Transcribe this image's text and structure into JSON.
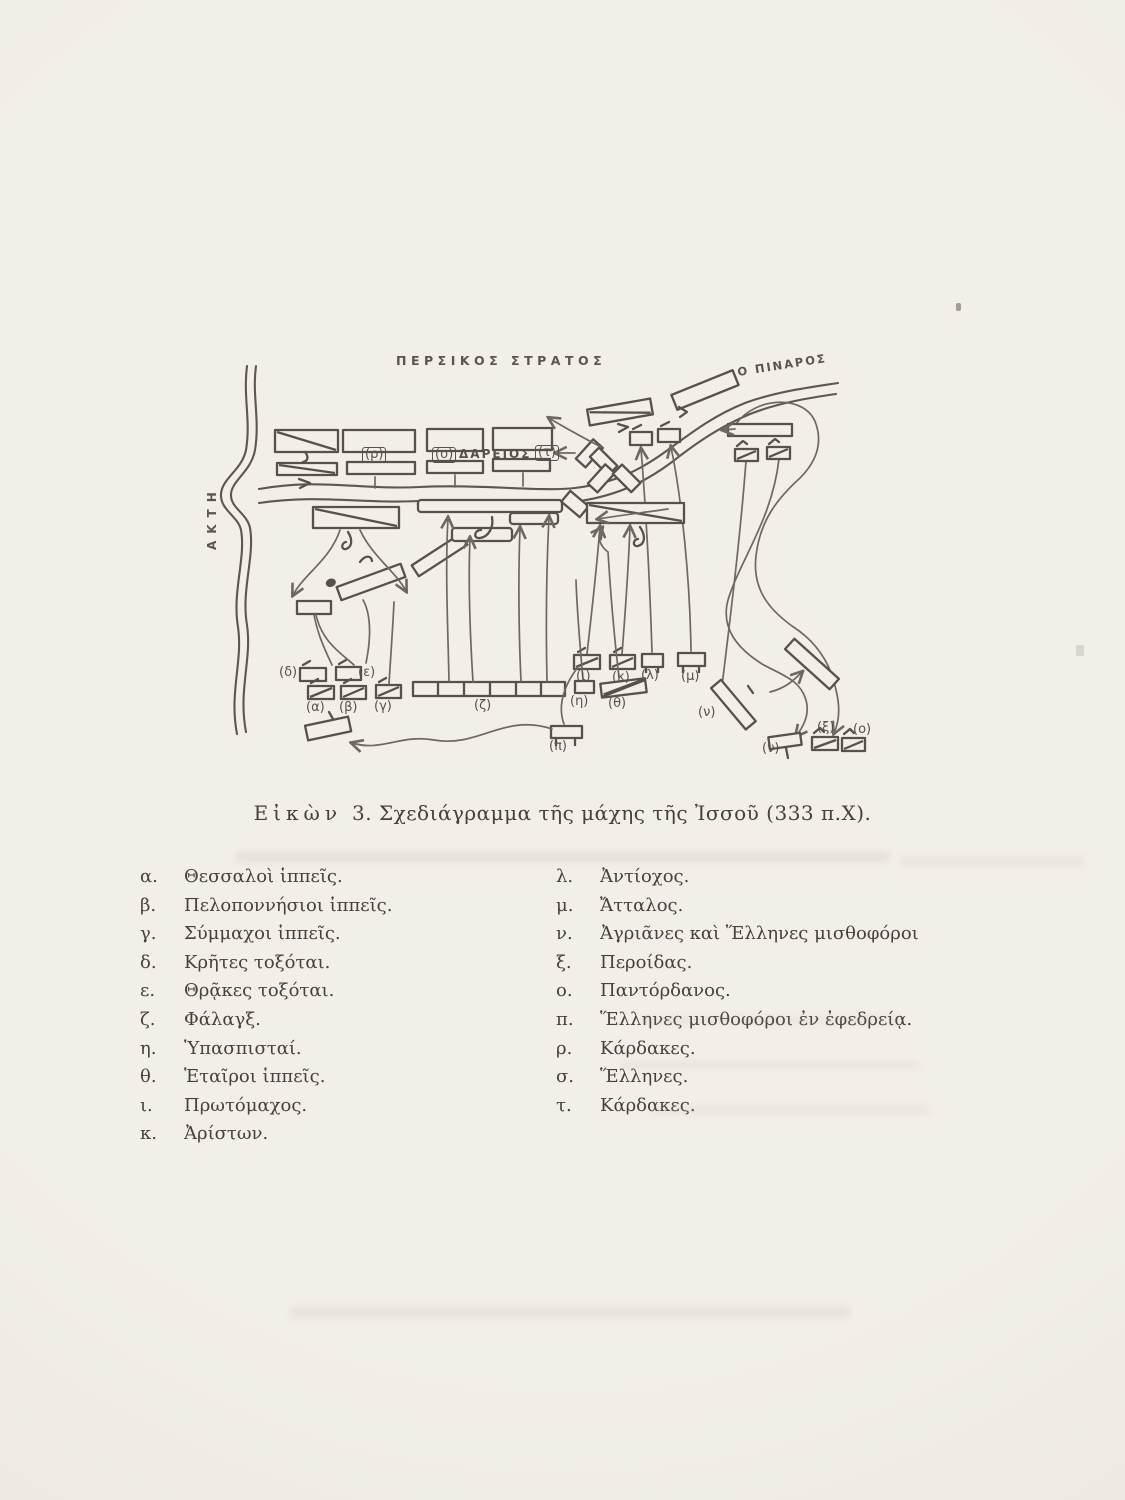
{
  "caption": {
    "figure_word": "Εἰκὼν",
    "rest": "3. Σχεδιάγραμμα τῆς μάχης τῆς Ἰσσοῦ (333 π.Χ)."
  },
  "diagram": {
    "persian_army_label": "ΠΕΡΣΙΚΟΣ ΣΤΡΑΤΟΣ",
    "pinaros_river_label": "Ο ΠΙΝΑΡΟΣ",
    "coast_label": "ΑΚΤΗ",
    "darius_label": "ΔΑΡΕΙΟΣ",
    "unit_labels": {
      "alpha": "(α)",
      "beta": "(β)",
      "gamma": "(γ)",
      "delta": "(δ)",
      "epsilon": "(ε)",
      "zeta": "(ζ)",
      "eta": "(η)",
      "theta": "(θ)",
      "iota": "(ι)",
      "kappa": "(κ)",
      "lambda": "(λ)",
      "mu": "(μ)",
      "nu_1": "(ν)",
      "nu_2": "(ν)",
      "xi": "(ξ)",
      "omicron": "(ο)",
      "pi": "(π)",
      "rho": "(ρ)",
      "sigma": "(σ)",
      "tau": "(τ)"
    }
  },
  "legend": {
    "left": [
      {
        "letter": "α.",
        "text": "Θεσσαλοὶ ἱππεῖς."
      },
      {
        "letter": "β.",
        "text": "Πελοποννήσιοι ἱππεῖς."
      },
      {
        "letter": "γ.",
        "text": "Σύμμαχοι ἱππεῖς."
      },
      {
        "letter": "δ.",
        "text": "Κρῆτες τοξόται."
      },
      {
        "letter": "ε.",
        "text": "Θρᾷκες τοξόται."
      },
      {
        "letter": "ζ.",
        "text": "Φάλαγξ."
      },
      {
        "letter": "η.",
        "text": "Ὑπασπισταί."
      },
      {
        "letter": "θ.",
        "text": "Ἑταῖροι ἱππεῖς."
      },
      {
        "letter": "ι.",
        "text": "Πρωτόμαχος."
      },
      {
        "letter": "κ.",
        "text": "Ἀρίστων."
      }
    ],
    "right": [
      {
        "letter": "λ.",
        "text": "Ἀντίοχος."
      },
      {
        "letter": "μ.",
        "text": "Ἄτταλος."
      },
      {
        "letter": "ν.",
        "text": "Ἀγριᾶνες καὶ Ἕλληνες μισθοφόροι"
      },
      {
        "letter": "ξ.",
        "text": "Περοίδας."
      },
      {
        "letter": "ο.",
        "text": "Παντόρδανος."
      },
      {
        "letter": "π.",
        "text": "Ἕλληνες μισθοφόροι ἐν ἐφεδρείᾳ."
      },
      {
        "letter": "ρ.",
        "text": "Κάρδακες."
      },
      {
        "letter": "σ.",
        "text": "Ἕλληνες."
      },
      {
        "letter": "τ.",
        "text": "Κάρδακες."
      }
    ]
  }
}
